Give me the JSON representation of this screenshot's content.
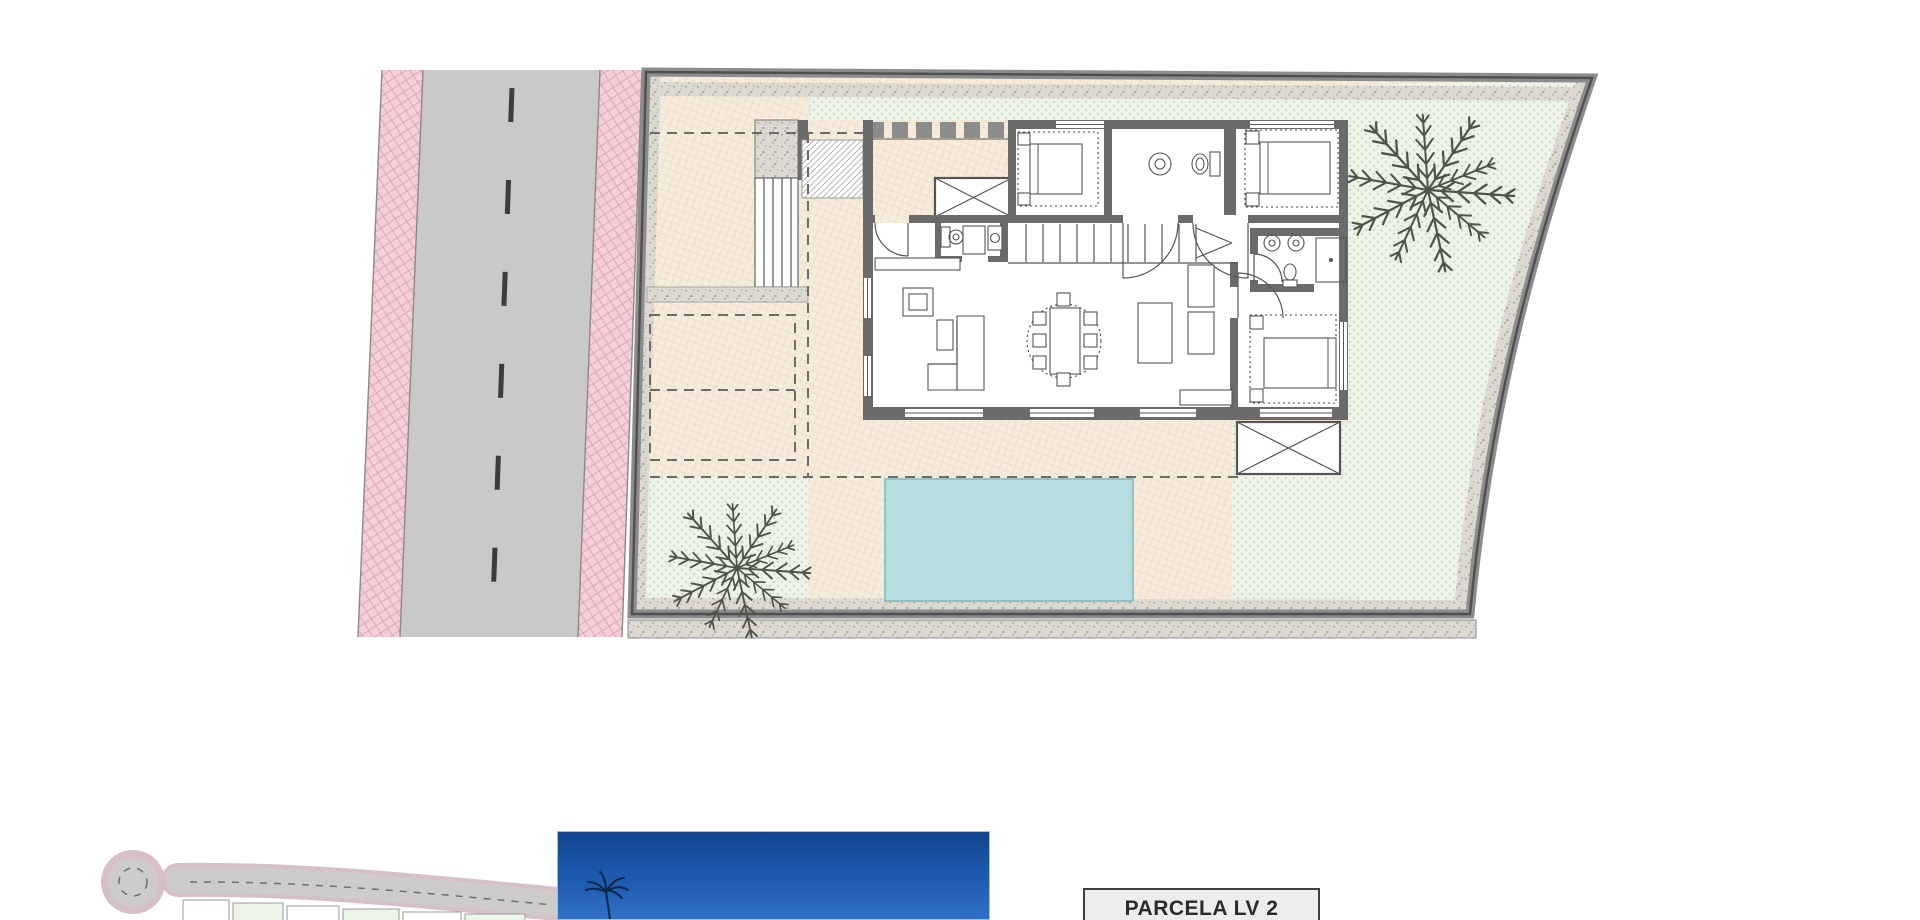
{
  "parcel_label": {
    "text": "PARCELA LV 2"
  },
  "colors": {
    "asphalt": "#c9c9c9",
    "sidewalk_pink": "#f4cfd7",
    "centerline": "#3d3d3d",
    "terrace": "#f5ecdc",
    "lawn": "#eef3e8",
    "gravel": "#dcd9d3",
    "boundary": "#8c8c8c",
    "wall": "#6b6b6b",
    "pool": "#b5dee1",
    "pool_edge": "#7fb9bd",
    "palm": "#4f544a",
    "photo_sky_top": "#13458f",
    "photo_sky_bottom": "#2f6fc5",
    "map_road": "#cecccb",
    "map_edge": "#d6bfc6",
    "label_bg": "#ededed",
    "label_border": "#3f3f3f",
    "label_text": "#2b2b2b"
  },
  "plan": {
    "type": "villa site / ground-floor plan",
    "features": [
      "street-with-dashed-centerline",
      "pink-paved-sidewalks",
      "walled-plot-with-curved-east-boundary",
      "single-storey-villa",
      "entrance-porch-with-slats",
      "staircase",
      "guest-wc",
      "two-bathrooms",
      "three-bedrooms",
      "living-dining-room-with-kitchen-island",
      "swimming-pool",
      "two-palm-trees",
      "dashed-parking-bay",
      "pergola",
      "cul-de-sac-site-key-map",
      "sky-photo-thumbnail"
    ]
  }
}
